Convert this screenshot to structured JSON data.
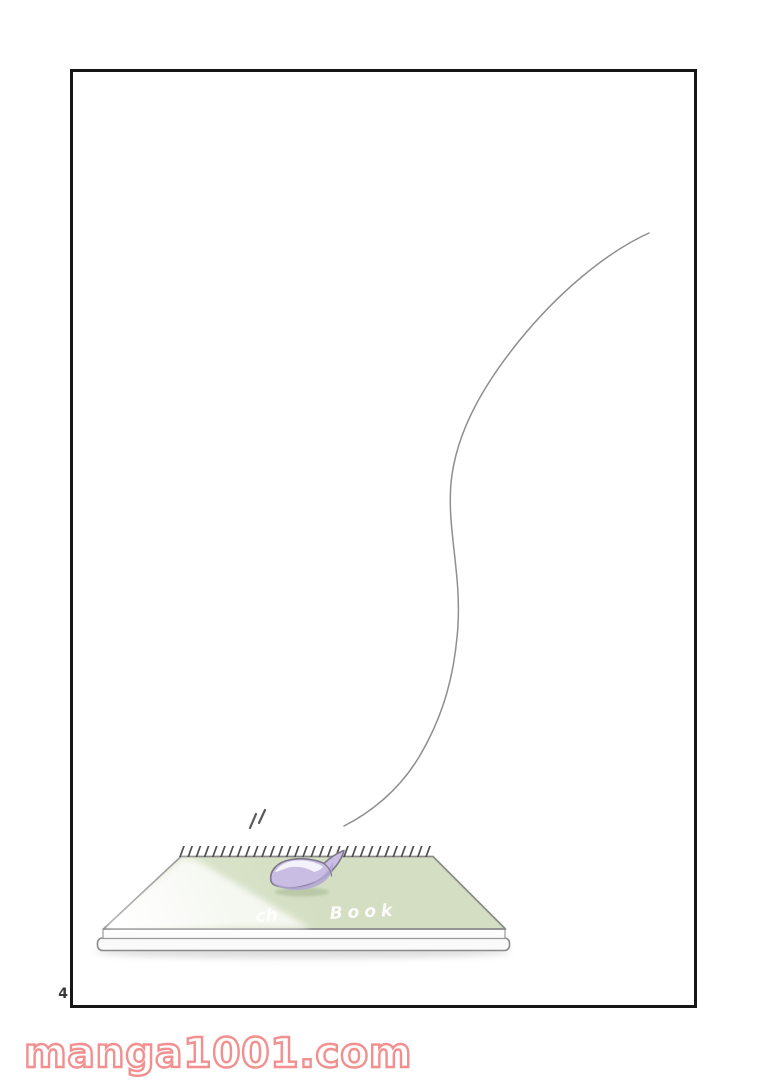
{
  "page": {
    "number": "4",
    "background": "#ffffff"
  },
  "panel": {
    "border_color": "#161616"
  },
  "artwork": {
    "string_color": "#8f8f8f",
    "sketchbook": {
      "cover_text_part1": "ch",
      "cover_text_part2": "Book",
      "cover_color": "#d5e0c4",
      "petal_color": "#c9bde4",
      "binding_color": "#4f4f4f"
    }
  },
  "watermark": {
    "text": "manga1001.com",
    "color": "#f28f8f"
  }
}
